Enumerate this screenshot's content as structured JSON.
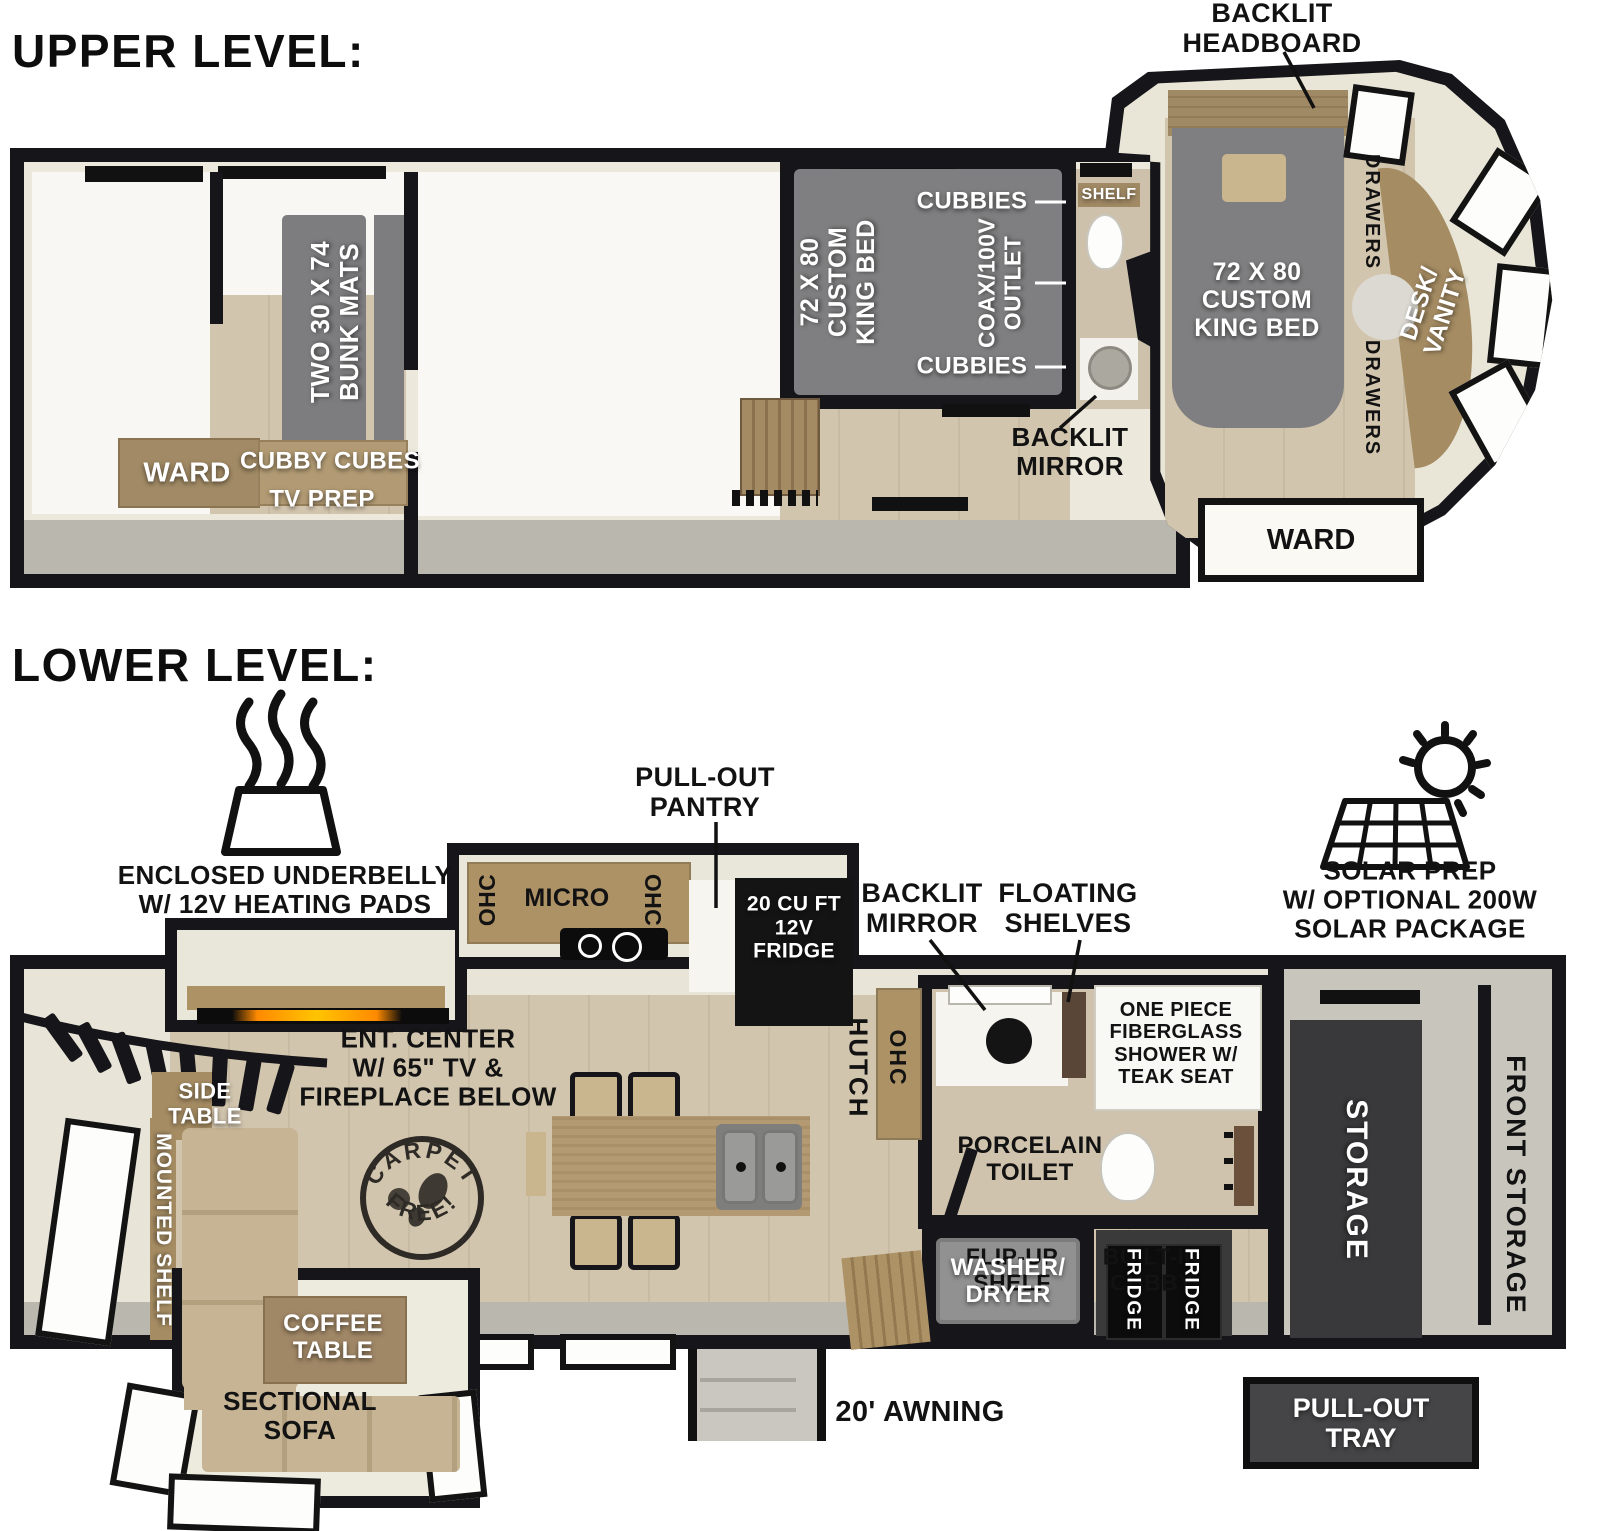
{
  "titles": {
    "upper": "UPPER LEVEL:",
    "lower": "LOWER LEVEL:"
  },
  "colors": {
    "wall": "#15151a",
    "cream": "#e9e5d8",
    "wood": "#ad9266",
    "wood_dark": "#a08766",
    "floor": "#d2c5ae",
    "mat_gray": "#7d7d7f",
    "walkway": "#b9b7ae",
    "dark_box": "#39393b",
    "flame_orange": "#ff9b1e",
    "label_white": "#ffffff",
    "label_black": "#121212"
  },
  "upper": {
    "bunk_mats": "TWO 30 X 74\nBUNK MATS",
    "ward_left": "WARD",
    "cubby_cubes": "CUBBY CUBES",
    "tv_prep": "TV PREP",
    "king_bed_mid": "72 X 80\nCUSTOM\nKING BED",
    "cubbies_top": "CUBBIES",
    "coax_outlet": "COAX/100V\nOUTLET",
    "cubbies_bottom": "CUBBIES",
    "shelf": "SHELF",
    "backlit_mirror": "BACKLIT\nMIRROR",
    "backlit_headboard": "BACKLIT\nHEADBOARD",
    "king_bed_front": "72 X 80\nCUSTOM\nKING BED",
    "drawers_top": "DRAWERS",
    "desk_vanity": "DESK/\nVANITY",
    "drawers_bottom": "DRAWERS",
    "ward_front": "WARD"
  },
  "lower": {
    "underbelly": "ENCLOSED UNDERBELLY\nW/ 12V HEATING PADS",
    "solar": "SOLAR PREP\nW/ OPTIONAL 200W\nSOLAR PACKAGE",
    "pull_out_pantry": "PULL-OUT\nPANTRY",
    "ohc_left": "OHC",
    "micro": "MICRO",
    "ohc_right": "OHC",
    "fridge_12v": "20 CU FT\n12V\nFRIDGE",
    "ent_center": "ENT. CENTER\nW/ 65\" TV &\nFIREPLACE BELOW",
    "side_table": "SIDE\nTABLE",
    "mounted_shelf": "MOUNTED SHELF",
    "coffee_table": "COFFEE\nTABLE",
    "sectional_sofa": "SECTIONAL\nSOFA",
    "carpet_free_top": "CARPET",
    "carpet_free_bottom": "FREE!",
    "hutch": "HUTCH",
    "ohc_hutch": "OHC",
    "backlit_mirror": "BACKLIT\nMIRROR",
    "floating_shelves": "FLOATING\nSHELVES",
    "shower": "ONE PIECE\nFIBERGLASS\nSHOWER W/\nTEAK SEAT",
    "porcelain_toilet": "PORCELAIN\nTOILET",
    "flip_up_shelf": "FLIP-UP\nSHELF",
    "built_in_cubby": "BUILT-IN\nCUBBY",
    "washer_dryer": "WASHER/\nDRYER",
    "fridge_a": "FRIDGE",
    "fridge_b": "FRIDGE",
    "storage": "STORAGE",
    "front_storage": "FRONT STORAGE",
    "pull_out_tray": "PULL-OUT\nTRAY",
    "awning": "20' AWNING"
  }
}
